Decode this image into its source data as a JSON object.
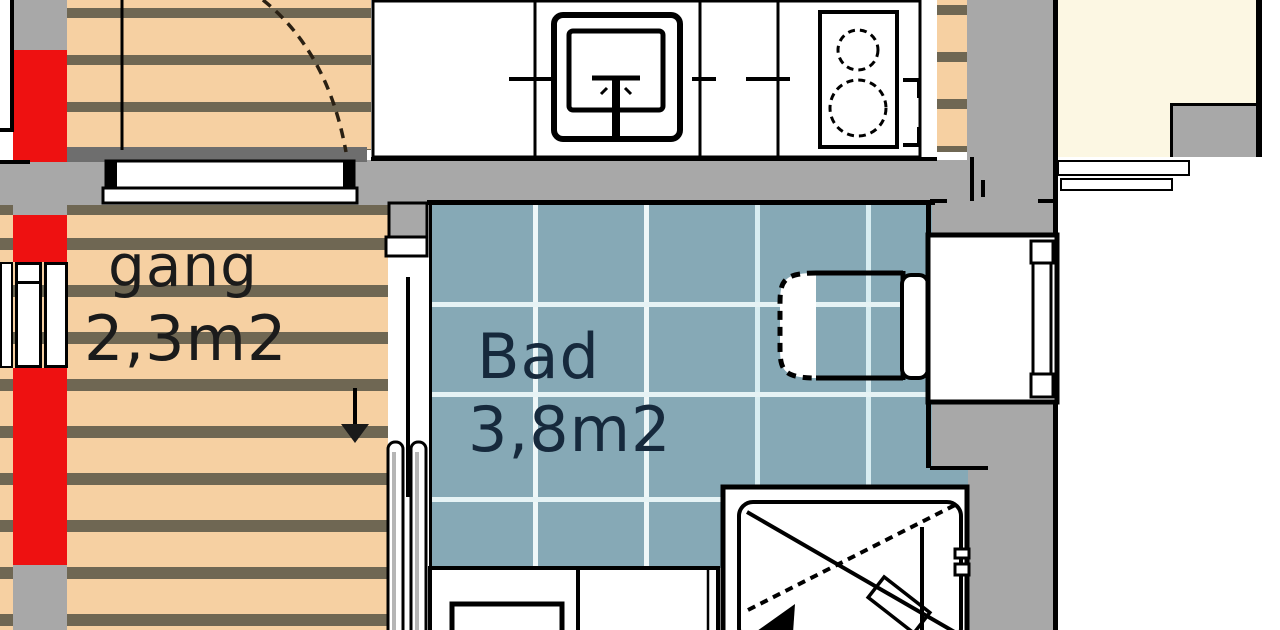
{
  "plan_title": "Apartment floor plan detail",
  "rooms": {
    "gang": {
      "name": "gang",
      "area": "2,3m2"
    },
    "bad": {
      "name": "Bad",
      "area": "3,8m2"
    }
  },
  "fixtures": [
    "staircase",
    "door-swing",
    "sliding-door",
    "kitchen-counter",
    "kitchen-sink",
    "stove",
    "toilet",
    "cistern-unit",
    "washbasin-counter",
    "shower",
    "bathroom-door",
    "stairs-direction-arrow"
  ],
  "colors": {
    "wall_gray": "#a8a8a8",
    "wall_dark_gray": "#6e6e6e",
    "floor_wood": "#f6d0a2",
    "floor_plank_line": "#6f6753",
    "section_red": "#ee1111",
    "tile_blue": "#86a9b6",
    "tile_grout": "#eef7f8",
    "room_cream": "#fcf7e3",
    "label_dark": "#1b1b1b",
    "label_navy": "#16293c",
    "line_black": "#000000"
  }
}
